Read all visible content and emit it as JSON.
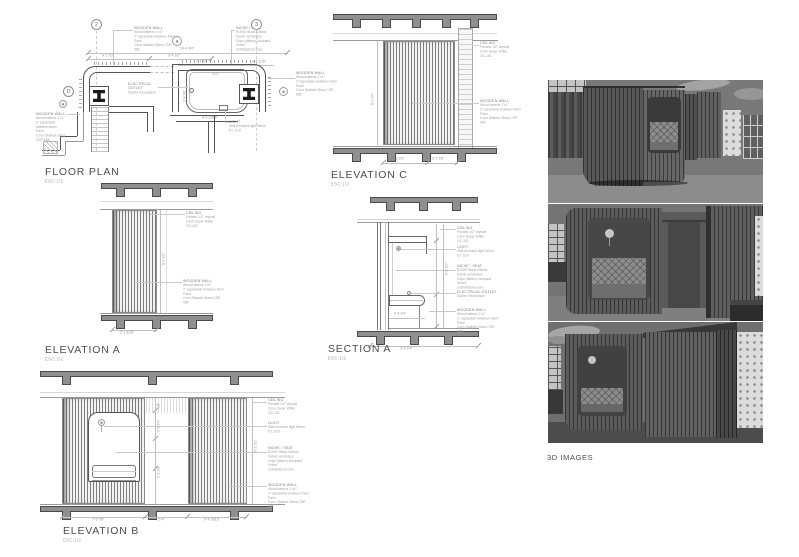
{
  "sheet": {
    "background": "#ffffff"
  },
  "notes": {
    "wooden_wall": {
      "title": "WOODEN WALL",
      "lines": [
        "Wood battens 1\"x1\"",
        "2\" separation between them",
        "Paint",
        "Color Stained Glass CSP-685"
      ]
    },
    "ceiling": {
      "title": "CEILING",
      "lines": [
        "Painted 1/2\" drywall",
        "Color Super White",
        "OC-152"
      ]
    },
    "light": {
      "title": "LIGHT",
      "lines": [
        "Wall mounted light fixture",
        "EY 15.8"
      ]
    },
    "niche_seat": {
      "title": "NICHE / SEAT",
      "lines": [
        "ROMO Black Edition",
        "Fabric upholstery",
        "Onyx (Italian) Jacquard",
        "Velvet",
        "Cobblestone Ecru"
      ]
    },
    "electrical_outlet": {
      "title": "ELECTRICAL OUTLET",
      "lines": [
        "Duplex Receptacle"
      ]
    }
  },
  "floor_plan": {
    "title": "FLOOR PLAN",
    "scale": "ESC:1/2",
    "grid_bubbles": [
      "2",
      "3"
    ],
    "detail_bubble": "D",
    "seat_label": "seat",
    "dims": {
      "overall": "14'-4 3/4\"",
      "segments": [
        "4'-2 1/2\"",
        "5'-4 1/2\"",
        "7'-4 5/8\"",
        "4'-2 1/16\""
      ],
      "niche_width": "6'-4 13/16\"",
      "niche_depth": "2'-8 7/8\""
    }
  },
  "elevation_c": {
    "title": "ELEVATION C",
    "scale": "ESC:1/2",
    "dims": {
      "bottom": [
        "5'-6 1/2\"",
        "3'-2 7/8\""
      ],
      "height": "8'-2 1/2\""
    }
  },
  "elevation_a": {
    "title": "ELEVATION A",
    "scale": "ESC:1/2",
    "dims": {
      "bottom": [
        "3'-1 5/16\""
      ],
      "height": "8'-2 1/2\""
    }
  },
  "section_a": {
    "title": "SECTION A",
    "scale": "ESC:1/2",
    "dims": {
      "bottom": [
        "3'-6 1/4\""
      ],
      "inner": "2'-4 1/4\"",
      "height": "8'-2 1/2\""
    }
  },
  "elevation_b": {
    "title": "ELEVATION B",
    "scale": "ESC:1/2",
    "dims": {
      "bottom": [
        "7'-6 7/8\"",
        "2'-4\"",
        "5'-4 15/16\""
      ],
      "mid": [
        "10\"",
        "2'-5 3/4\"",
        "1'-2 1/8\""
      ],
      "height": "8'-2 1/2\""
    }
  },
  "renders": {
    "title": "3D IMAGES"
  }
}
